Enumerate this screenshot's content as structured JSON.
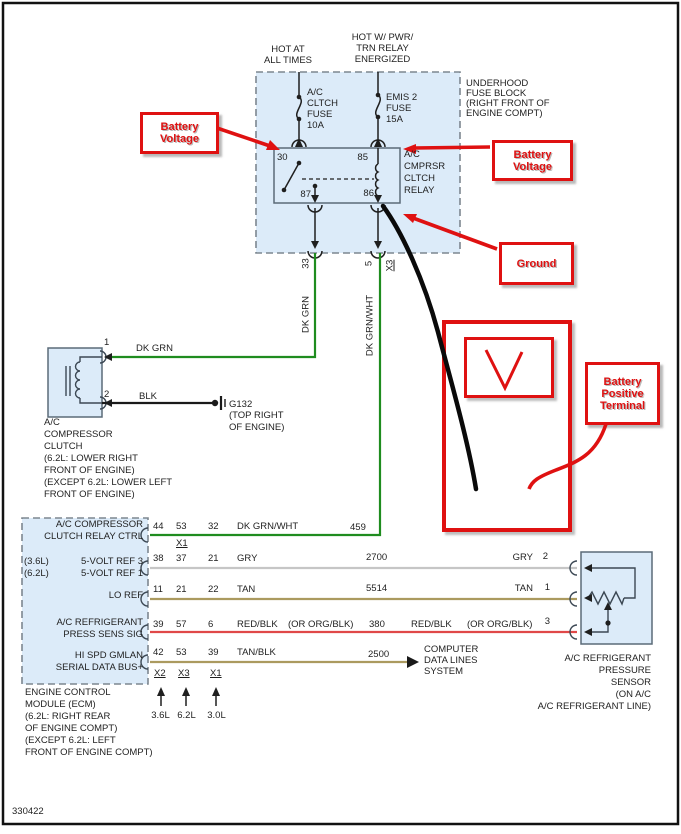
{
  "footer": {
    "diagram_number": "330422"
  },
  "colors": {
    "callout_red": "#df1111",
    "component_fill": "#dcebf9",
    "wire_dk_grn": "#1f8c1f",
    "wire_gry": "#c6c6c6",
    "wire_tan": "#ab9a5f",
    "wire_red": "#e04848",
    "wire_blk": "#1a1a1a"
  },
  "fuse_block": {
    "supply_left": "HOT AT\nALL TIMES",
    "supply_right": "HOT W/ PWR/\nTRN RELAY\nENERGIZED",
    "title": "UNDERHOOD\nFUSE BLOCK\n(RIGHT FRONT OF\nENGINE COMPT)",
    "fuse1": "A/C\nCLTCH\nFUSE\n10A",
    "fuse2": "EMIS 2\nFUSE\n15A",
    "relay": {
      "title": "A/C\nCMPRSR\nCLTCH\nRELAY",
      "pin_30": "30",
      "pin_85": "85",
      "pin_86": "86",
      "pin_87": "87"
    },
    "exit_pin_left": "33",
    "exit_pin_right": "5",
    "exit_connector_right": "X3"
  },
  "callouts": {
    "battery_voltage_left": "Battery\nVoltage",
    "battery_voltage_right": "Battery\nVoltage",
    "ground": "Ground",
    "battery_positive_terminal": "Battery\nPositive\nTerminal"
  },
  "wires": {
    "dk_grn_vertical": "DK GRN",
    "dk_grn_wht_vertical": "DK GRN/WHT"
  },
  "compressor": {
    "pin_1": "1",
    "pin_2": "2",
    "wire_1": "DK GRN",
    "wire_2": "BLK",
    "ground_id": "G132",
    "ground_location": "(TOP RIGHT\nOF ENGINE)",
    "label": "A/C\nCOMPRESSOR\nCLUTCH\n(6.2L: LOWER RIGHT\nFRONT OF ENGINE)\n(EXCEPT 6.2L: LOWER LEFT\nFRONT OF ENGINE)"
  },
  "ecm": {
    "label": "ENGINE CONTROL\nMODULE (ECM)\n(6.2L: RIGHT REAR\nOF ENGINE COMPT)\n(EXCEPT 6.2L: LEFT\nFRONT OF ENGINE COMPT)",
    "rows": [
      {
        "name": "A/C COMPRESSOR\nCLUTCH RELAY CTRL",
        "pin_a": "44",
        "pin_b": "53",
        "pin_c": "32",
        "connector": "X1",
        "wire": "DK GRN/WHT",
        "circuit": "459"
      },
      {
        "variants": "(3.6L)\n(6.2L)",
        "name": "5-VOLT REF 3\n5-VOLT REF 1",
        "pin_a": "38",
        "pin_b": "37",
        "pin_c": "21",
        "wire": "GRY",
        "circuit": "2700",
        "dest_wire": "GRY",
        "dest_pin": "2"
      },
      {
        "name": "LO REF",
        "pin_a": "11",
        "pin_b": "21",
        "pin_c": "22",
        "wire": "TAN",
        "circuit": "5514",
        "dest_wire": "TAN",
        "dest_pin": "1"
      },
      {
        "name": "A/C REFRIGERANT\nPRESS SENS SIG",
        "pin_a": "39",
        "pin_b": "57",
        "pin_c": "6",
        "wire": "RED/BLK",
        "wire_alt": "(OR ORG/BLK)",
        "circuit": "380",
        "dest_wire": "RED/BLK",
        "dest_alt": "(OR ORG/BLK)",
        "dest_pin": "3"
      },
      {
        "name": "HI SPD GMLAN\nSERIAL DATA BUS+",
        "pin_a": "42",
        "pin_b": "53",
        "pin_c": "39",
        "wire": "TAN/BLK",
        "circuit": "2500",
        "destination": "COMPUTER\nDATA LINES\nSYSTEM"
      }
    ],
    "bottom_connectors": [
      "X2",
      "X3",
      "X1"
    ],
    "engine_variants": [
      "3.6L",
      "6.2L",
      "3.0L"
    ]
  },
  "sensor": {
    "label": "A/C REFRIGERANT\nPRESSURE\nSENSOR\n(ON A/C\nA/C REFRIGERANT LINE)"
  }
}
